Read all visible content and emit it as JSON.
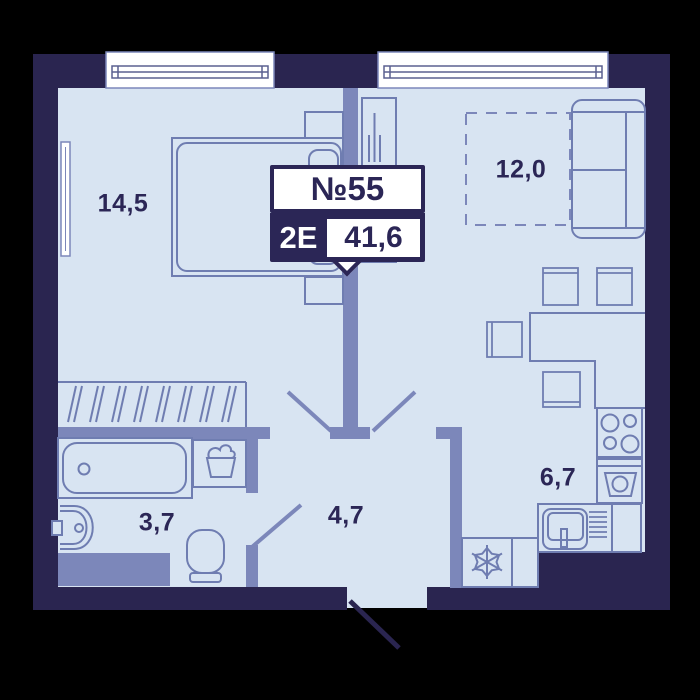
{
  "unit_badge": {
    "number": "№55",
    "type": "2Е",
    "area": "41,6"
  },
  "rooms": {
    "bedroom": {
      "label": "14,5"
    },
    "living": {
      "label": "12,0"
    },
    "kitchen": {
      "label": "6,7"
    },
    "hall": {
      "label": "4,7"
    },
    "bathroom": {
      "label": "3,7"
    }
  },
  "icons": {
    "fridge": "snowflake-icon",
    "washer": "washing-machine-icon",
    "stove": "stove-burners-icon",
    "basket": "laundry-basket-icon"
  },
  "colors": {
    "background": "#000000",
    "wall": "#2a2550",
    "floor": "#d8e4f2",
    "partition": "#7c87ba",
    "furniture_stroke": "#6f7db1",
    "text": "#2b2656",
    "badge_bg": "#ffffff"
  }
}
